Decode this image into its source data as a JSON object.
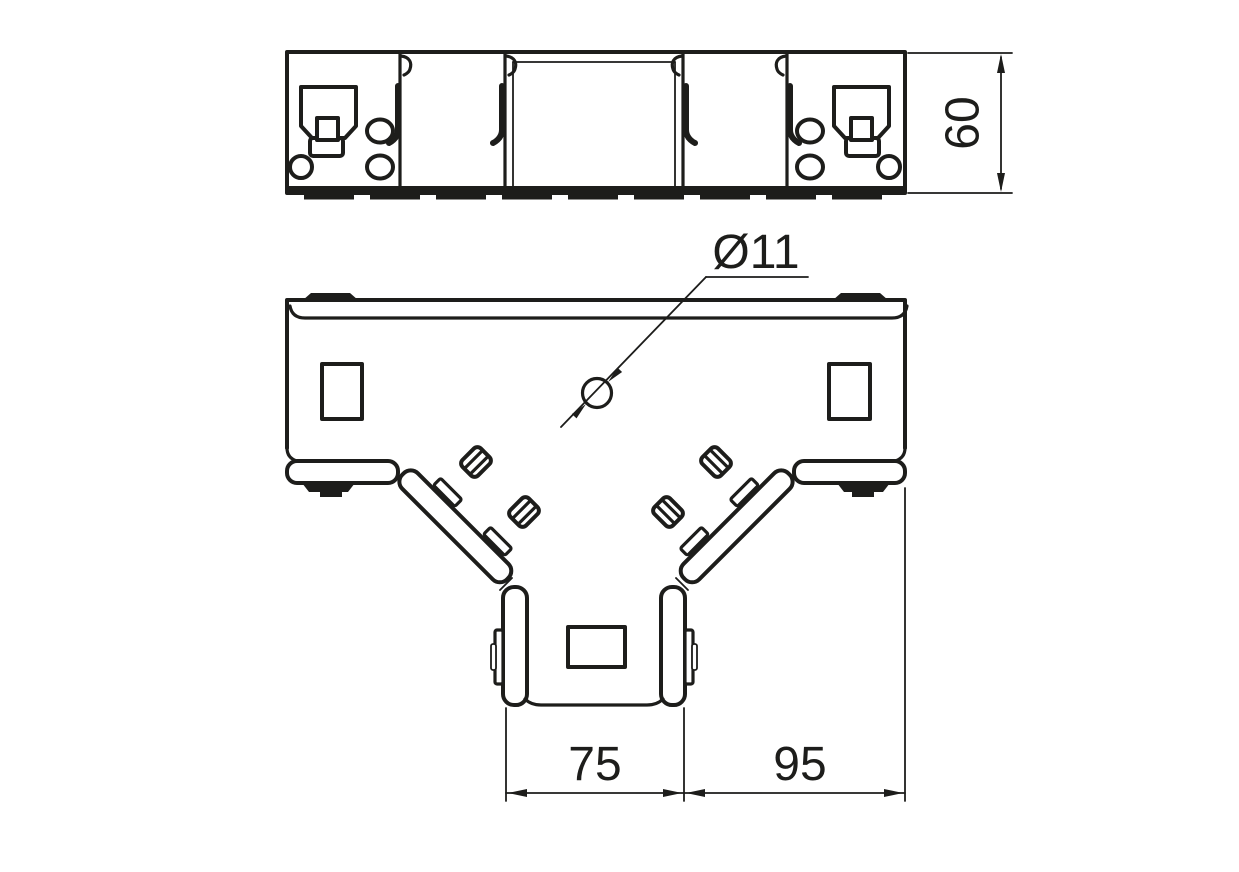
{
  "colors": {
    "line_color": "#1d1d1b",
    "background_color": "#ffffff"
  },
  "front_view": {
    "height_label": "60"
  },
  "plan_view": {
    "hole_label": "Ø11",
    "branch_width_label": "75",
    "side_width_label": "95"
  }
}
